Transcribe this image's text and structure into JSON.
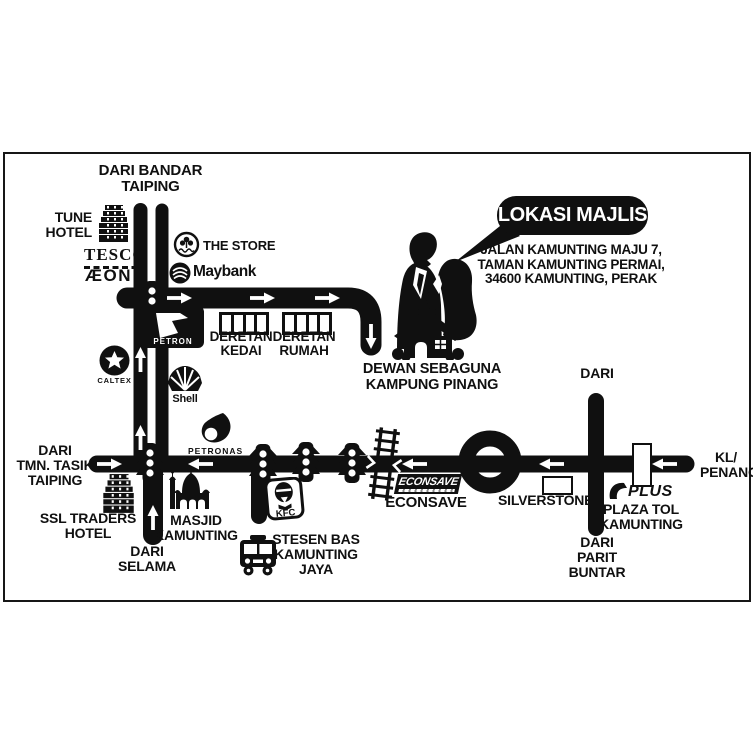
{
  "colors": {
    "background": "#ffffff",
    "ink": "#101010"
  },
  "bubble": {
    "title": "LOKASI MAJLIS",
    "address": [
      "JALAN KAMUNTING MAJU 7,",
      "TAMAN KAMUNTING PERMAI,",
      "34600 KAMUNTING, PERAK"
    ]
  },
  "venue": {
    "name": [
      "DEWAN SEBAGUNA",
      "KAMPUNG PINANG"
    ]
  },
  "directions": {
    "bandar_taiping": [
      "DARI BANDAR",
      "TAIPING"
    ],
    "tmn_tasik_taiping": [
      "DARI",
      "TMN. TASIK",
      "TAIPING"
    ],
    "selama": [
      "DARI",
      "SELAMA"
    ],
    "parit_buntar": [
      "DARI",
      "PARIT",
      "BUNTAR"
    ],
    "north": "DARI",
    "kl_penang": [
      "KL/",
      "PENANG"
    ]
  },
  "landmarks": {
    "tune_hotel": [
      "TUNE",
      "HOTEL"
    ],
    "tesco": "TESCO",
    "aeon": "ÆON",
    "the_store": "THE STORE",
    "maybank": "Maybank",
    "petron": "PETRON",
    "deretan_kedai": [
      "DERETAN",
      "KEDAI"
    ],
    "deretan_rumah": [
      "DERETAN",
      "RUMAH"
    ],
    "shell": "Shell",
    "caltex": "CALTEX",
    "petronas": "PETRONAS",
    "masjid_kamunting": [
      "MASJID",
      "KAMUNTING"
    ],
    "ssl_traders_hotel": [
      "SSL TRADERS",
      "HOTEL"
    ],
    "kfc": "KFC",
    "stesen_bas": [
      "STESEN BAS",
      "KAMUNTING",
      "JAYA"
    ],
    "econsave_logo": "ECONSAVE",
    "econsave": "ECONSAVE",
    "silverstone": "SILVERSTONE",
    "plus": "PLUS",
    "plaza_tol": [
      "PLAZA TOL",
      "KAMUNTING"
    ]
  },
  "map_features": {
    "roundabout": "roundabout",
    "railway_crossing": "railway crossing",
    "traffic_lights_count": 5
  }
}
